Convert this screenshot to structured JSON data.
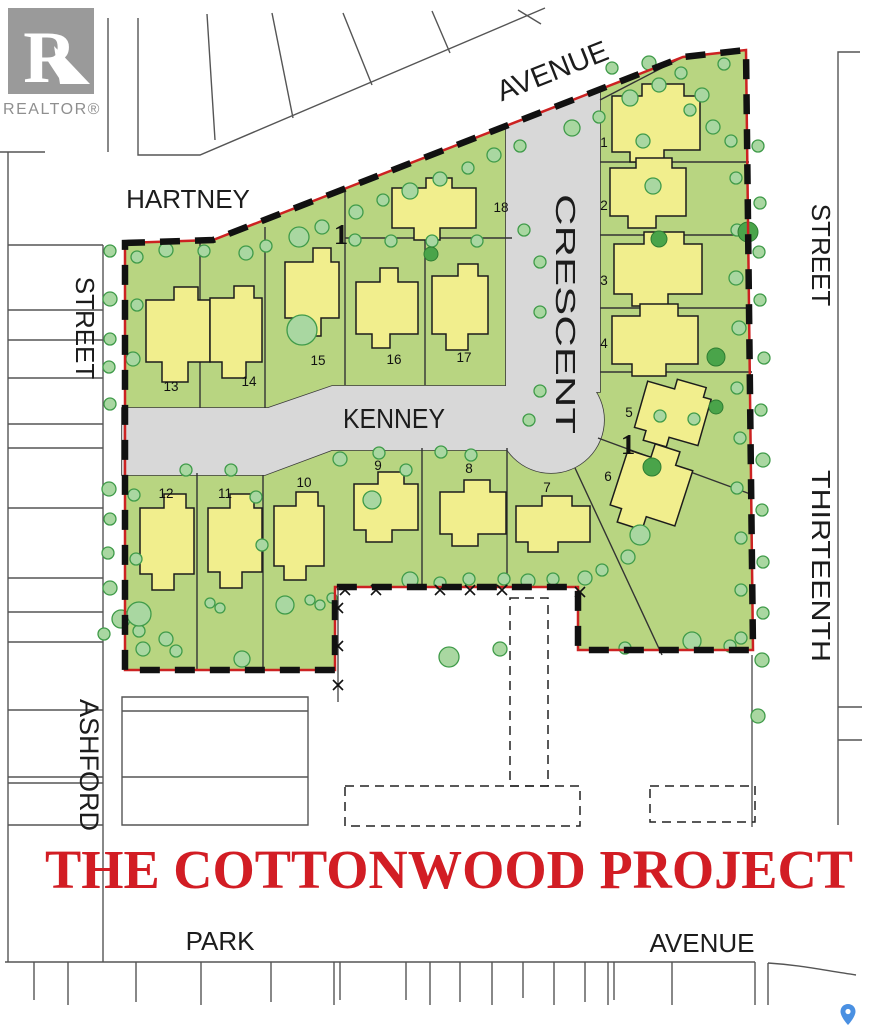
{
  "title": {
    "text": "THE COTTONWOOD PROJECT",
    "color": "#d21d24"
  },
  "branding": {
    "logo_letter": "R",
    "logo_text": "REALTOR®"
  },
  "streets": {
    "avenue_top": "AVENUE",
    "hartney": "HARTNEY",
    "crescent": "CRESCENT",
    "street_left": "STREET",
    "street_right": "STREET",
    "thirteenth": "THIRTEENTH",
    "kenney": "KENNEY",
    "ashford": "ASHFORD",
    "park": "PARK",
    "avenue_bottom": "AVENUE"
  },
  "blocks": [
    {
      "label": "1"
    },
    {
      "label": "1"
    }
  ],
  "lots": [
    {
      "label": "1"
    },
    {
      "label": "2"
    },
    {
      "label": "3"
    },
    {
      "label": "4"
    },
    {
      "label": "5"
    },
    {
      "label": "6"
    },
    {
      "label": "7"
    },
    {
      "label": "8"
    },
    {
      "label": "9"
    },
    {
      "label": "10"
    },
    {
      "label": "11"
    },
    {
      "label": "12"
    },
    {
      "label": "13"
    },
    {
      "label": "14"
    },
    {
      "label": "15"
    },
    {
      "label": "16"
    },
    {
      "label": "17"
    },
    {
      "label": "18"
    }
  ],
  "colors": {
    "parcel_green": "#b8d581",
    "road_gray": "#d8d8d8",
    "tree_fill": "#a9d7a1",
    "tree_outline": "#3f9b49",
    "tree_dark": "#4aa44a",
    "house_yellow": "#f1ee8d",
    "boundary_red": "#cc2222",
    "boundary_black": "#111111",
    "title_red": "#d21d24",
    "line_gray": "#555555",
    "pin_blue": "#4a90e2"
  }
}
